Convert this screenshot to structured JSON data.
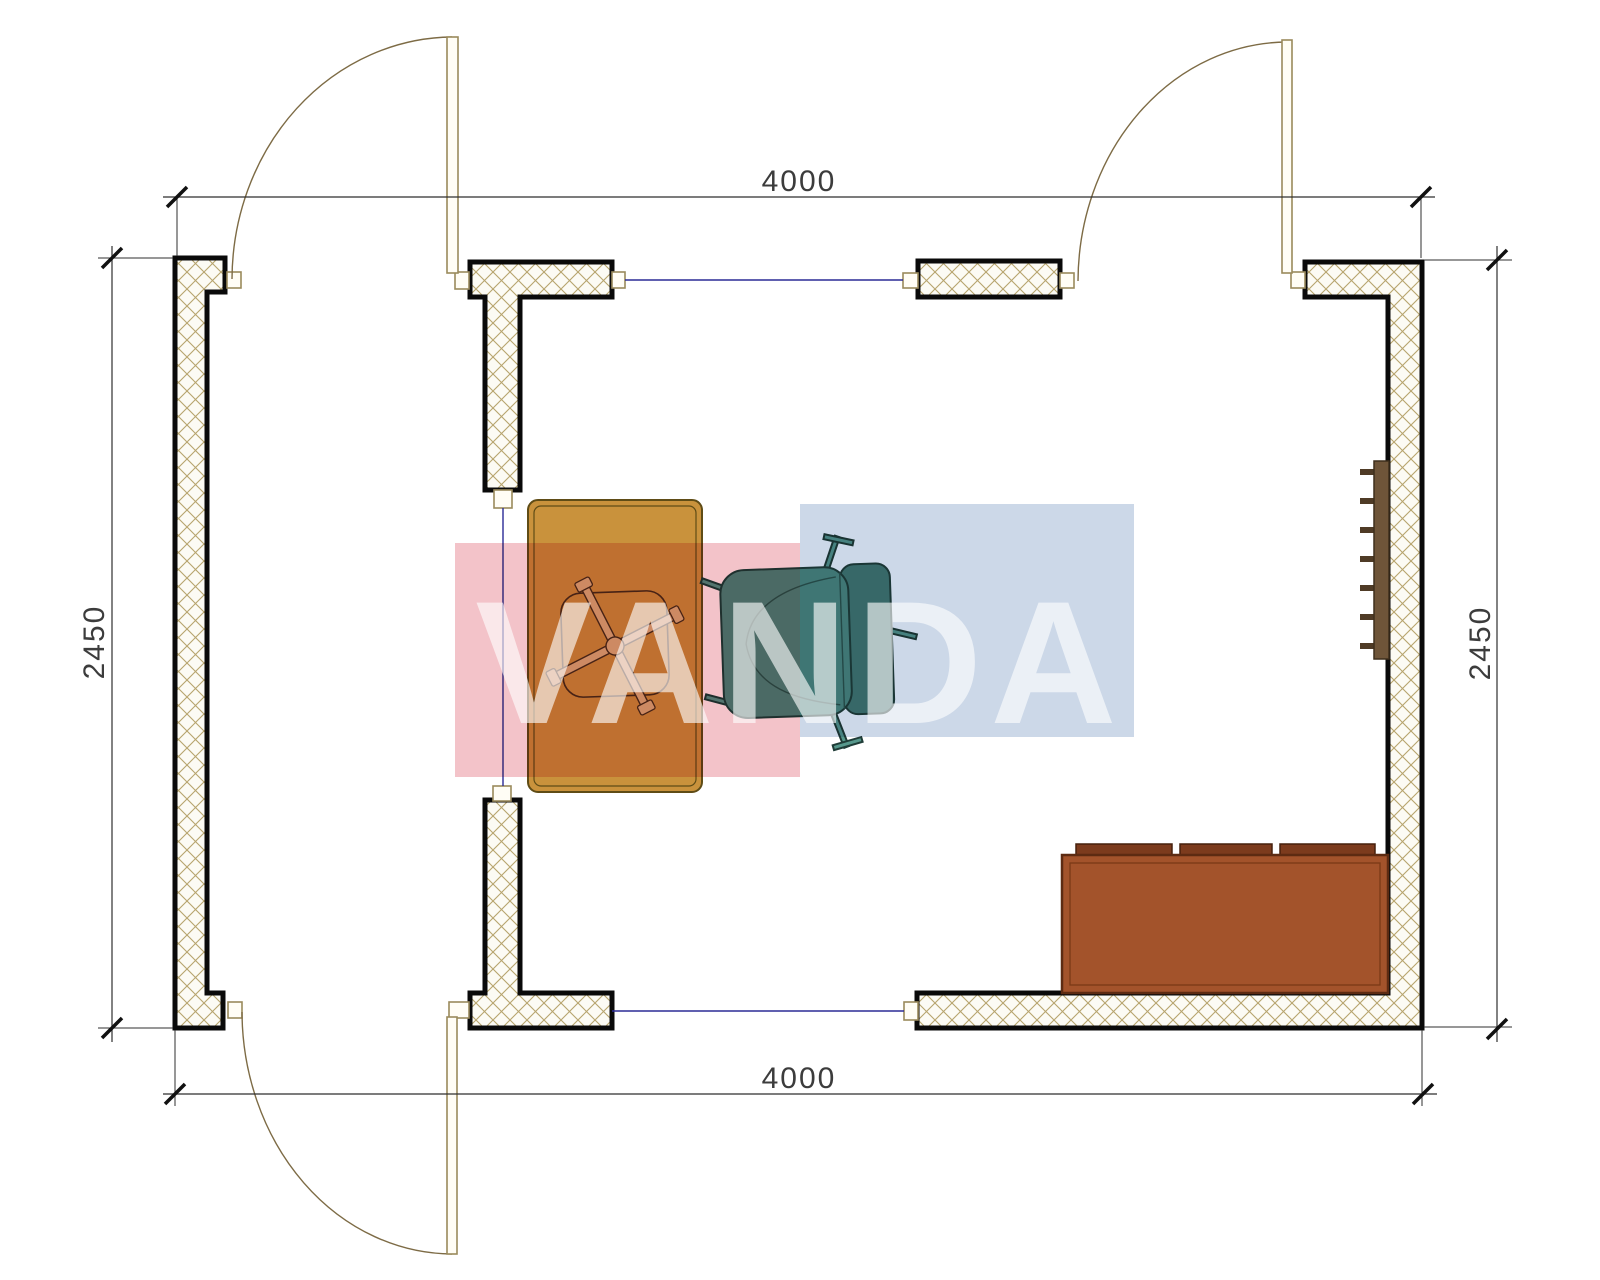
{
  "drawing": {
    "title": "room-floor-plan",
    "dimensions": {
      "top": "4000",
      "bottom": "4000",
      "left": "2450",
      "right": "2450"
    },
    "watermark": {
      "text": "VANDA",
      "pink_color": "#f3c3c9",
      "blue_color": "#ccd8e8",
      "text_color": "#ffffff"
    },
    "colors": {
      "wall_fill": "#fcfbf4",
      "wall_hatch": "#b7a46d",
      "wall_outline": "#0a0a0a",
      "door": "#9a8a5c",
      "module_line": "#2b2b96",
      "desk": "#c9923c",
      "chair_base": "#d7b57e",
      "armchair_seat": "#4f8b80",
      "armchair_back": "#447b72",
      "sofa_body": "#a3532b",
      "sofa_cushion": "#7c3b1d",
      "radiator_body": "#6f5539",
      "radiator_fin": "#4f3b26"
    },
    "furniture": [
      {
        "name": "desk"
      },
      {
        "name": "office-chair"
      },
      {
        "name": "armchair"
      },
      {
        "name": "sofa"
      },
      {
        "name": "radiator"
      }
    ]
  }
}
